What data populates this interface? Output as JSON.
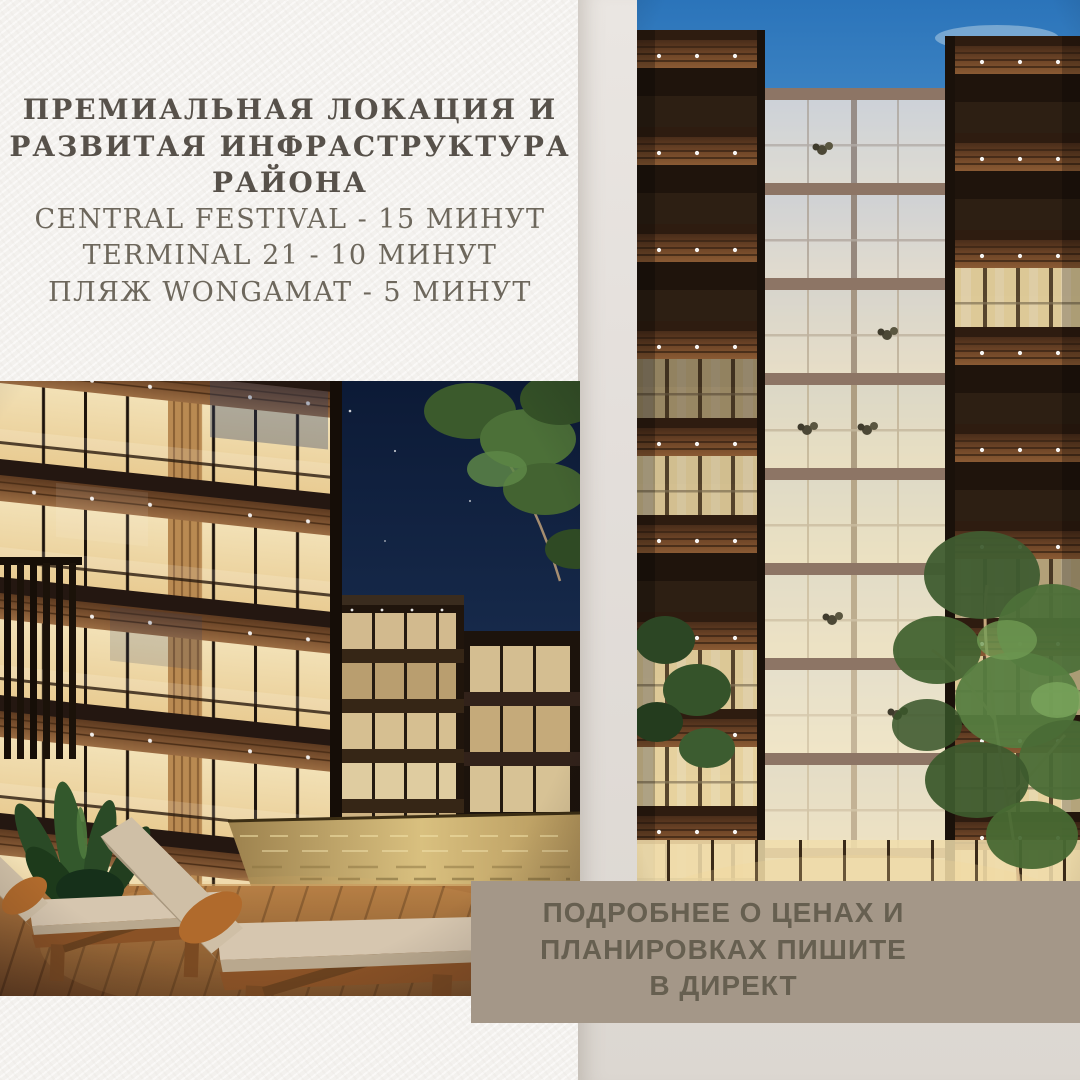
{
  "palette": {
    "paper_bg": "#f4f2ef",
    "right_column_top": "#eae6e2",
    "right_column_bottom": "#dcd7d1",
    "headline_bold_color": "#57514a",
    "headline_light_color": "#6d675c",
    "cta_bg": "#a49788",
    "cta_text_color": "#665f50",
    "sky_day": "#2b74ba",
    "sky_night": "#0c1a36",
    "window_glow": "#f1dca6",
    "wood_dark": "#3a281c"
  },
  "headline": {
    "bold_lines": [
      "ПРЕМИАЛЬНАЯ ЛОКАЦИЯ И",
      "РАЗВИТАЯ ИНФРАСТРУКТУРА",
      "РАЙОНА"
    ],
    "light_lines": [
      "CENTRAL FESTIVAL - 15 МИНУТ",
      "TERMINAL 21 - 10 МИНУТ",
      "ПЛЯЖ WONGAMAT - 5 МИНУТ"
    ]
  },
  "cta_banner": {
    "lines": [
      "ПОДРОБНЕЕ О ЦЕНАХ И",
      "ПЛАНИРОВКАХ ПИШИТЕ",
      "В ДИРЕКТ"
    ]
  },
  "images": {
    "left_photo_alt": "Вечерний двор с бассейном и деревянными шезлонгами",
    "right_photo_alt": "Фасад жилого дома с подсвеченными окнами в сумерках"
  }
}
